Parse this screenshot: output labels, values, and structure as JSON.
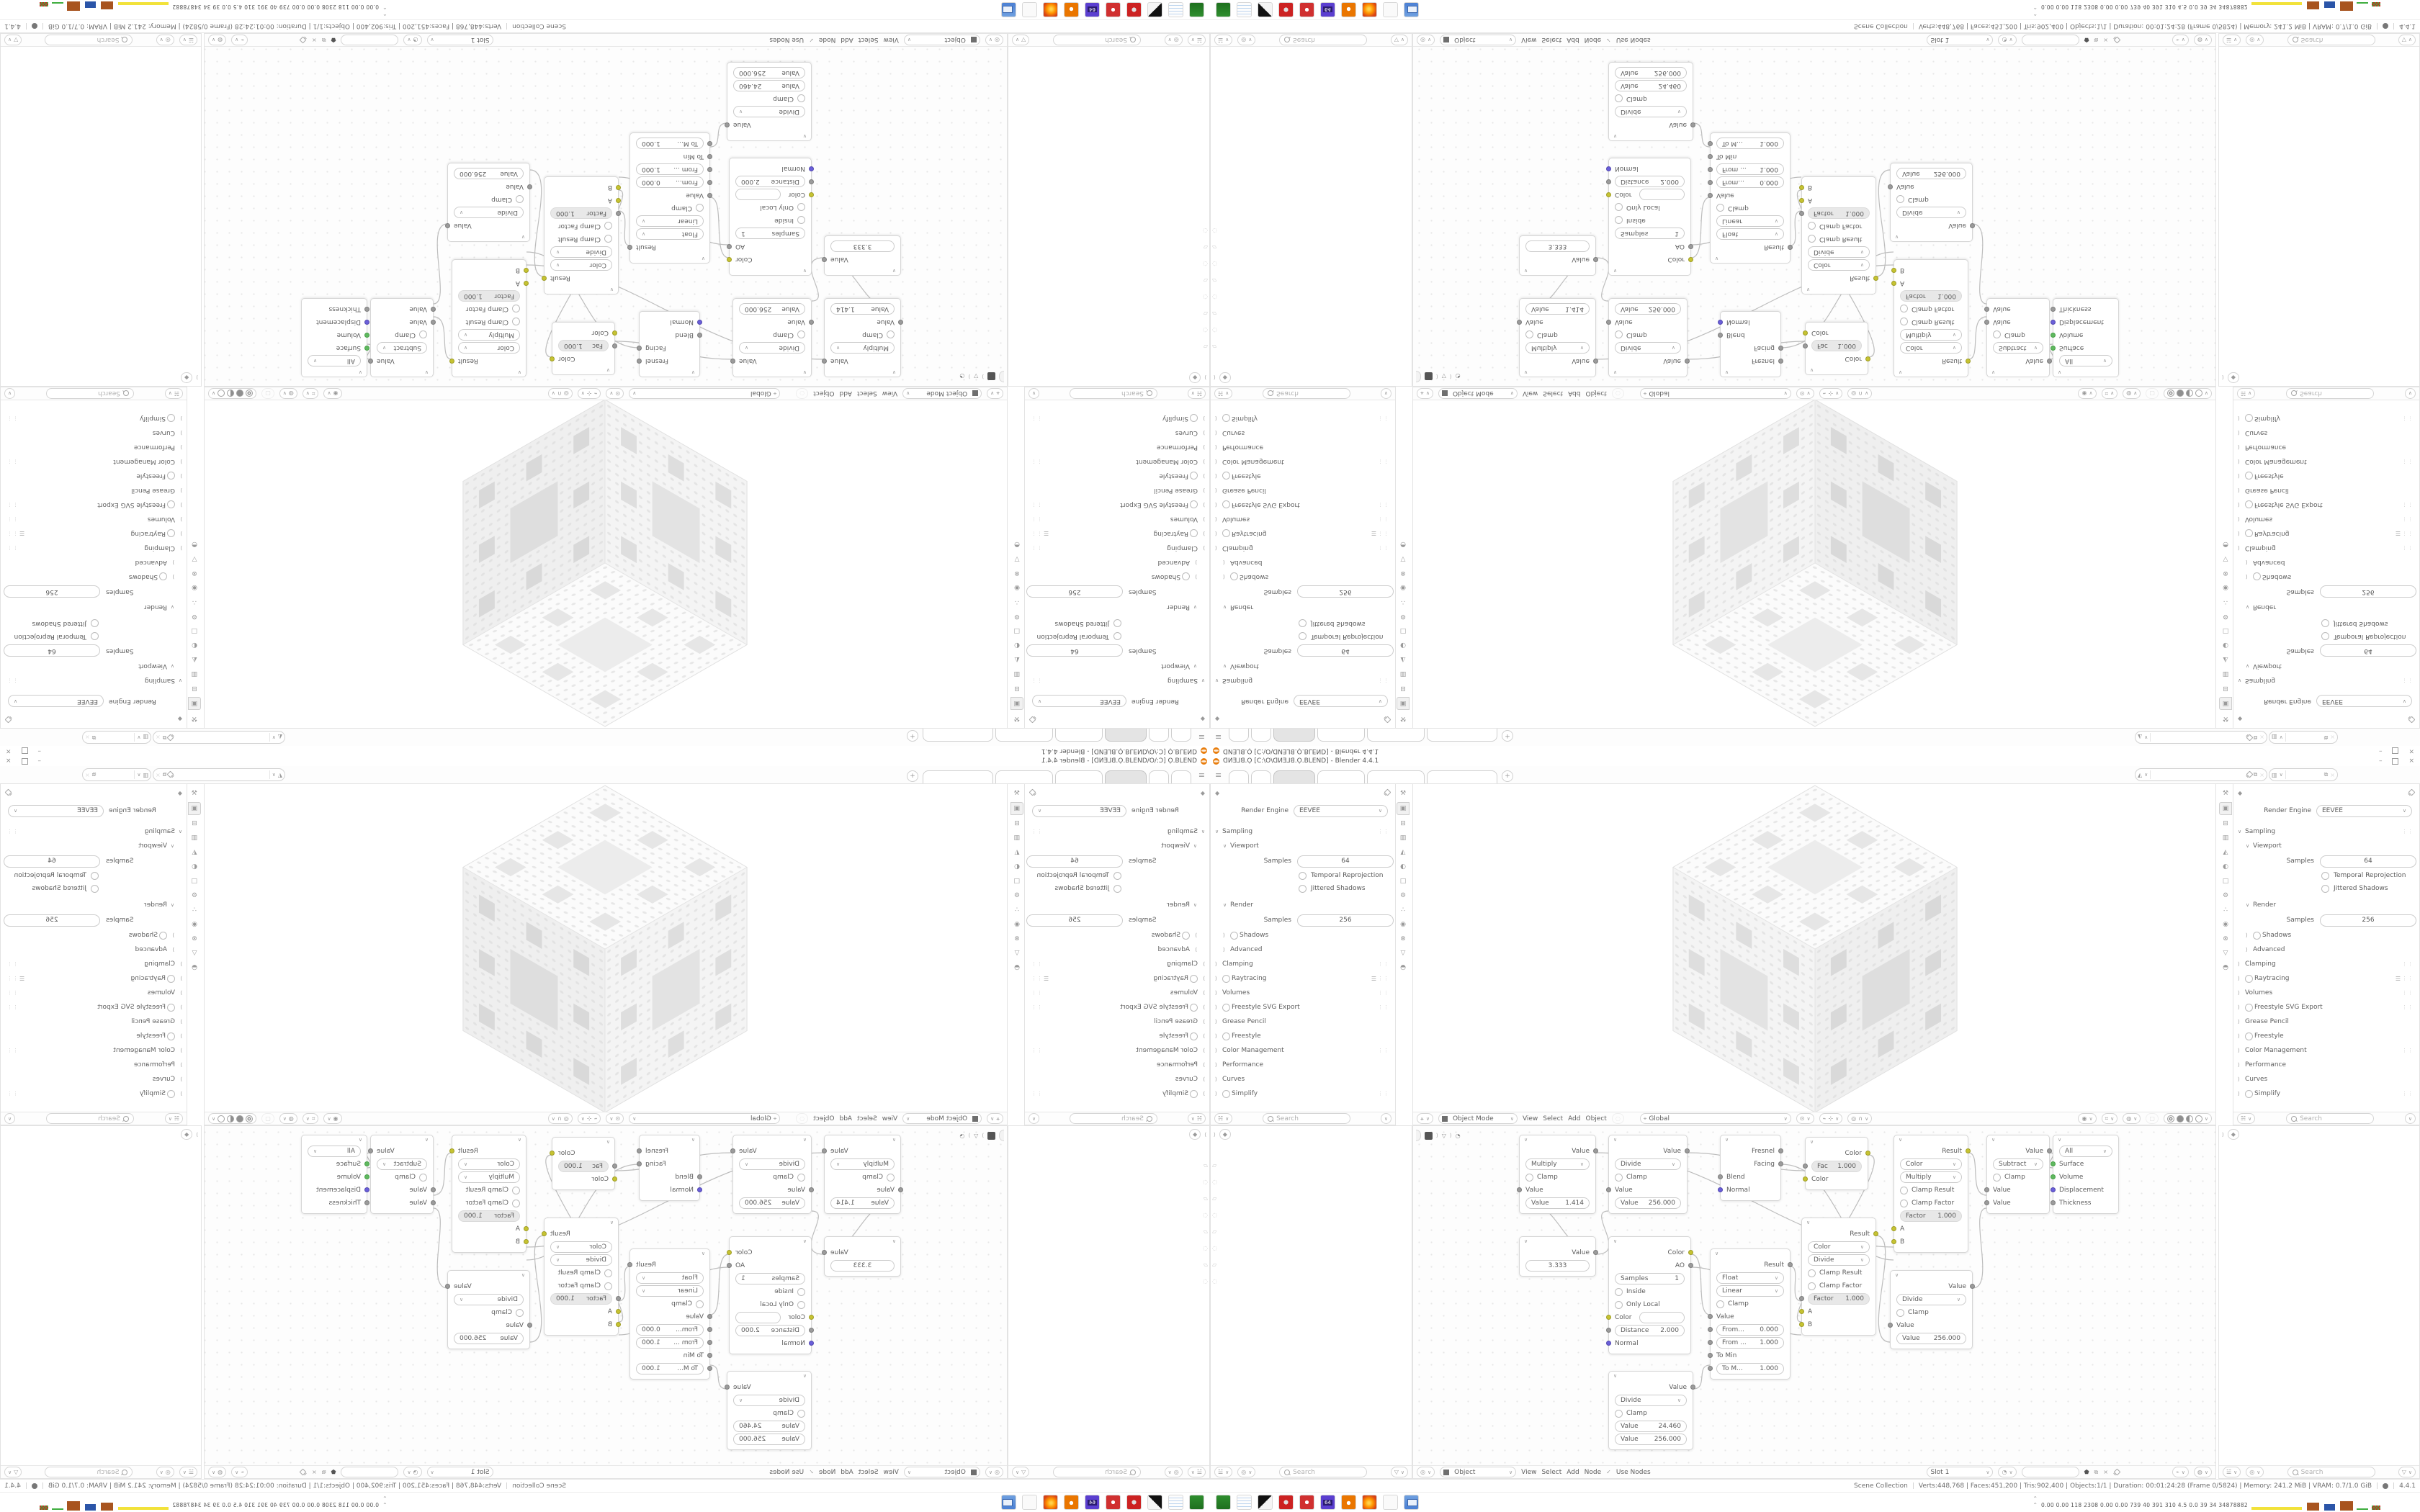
{
  "window": {
    "title": "ᗡИƎ⅃ꓭ.Ọ [C:\\O\\ᗡИƎ⅃ꓭ.Ọ.BLEND] - Blender 4.4.1",
    "minimize": "–",
    "close": "×"
  },
  "topbar": {
    "hamburger": "≡",
    "add_tab": "+",
    "workspace_tabs_blank": 6
  },
  "props": {
    "render_engine_label": "Render Engine",
    "render_engine_value": "EEVEE",
    "search_placeholder": "Search",
    "rows": [
      {
        "label": "Sampling"
      },
      {
        "label": "Viewport"
      },
      {
        "label": "Samples",
        "value": "64"
      },
      {
        "label": "Temporal Reprojection"
      },
      {
        "label": "Jittered Shadows"
      },
      {
        "label": "Render"
      },
      {
        "label": "Samples",
        "value": "256"
      },
      {
        "label": "Shadows"
      },
      {
        "label": "Advanced"
      },
      {
        "label": "Clamping"
      },
      {
        "label": "Raytracing"
      },
      {
        "label": "Volumes"
      },
      {
        "label": "Freestyle SVG Export"
      },
      {
        "label": "Grease Pencil"
      },
      {
        "label": "Freestyle"
      },
      {
        "label": "Color Management"
      },
      {
        "label": "Performance"
      },
      {
        "label": "Curves"
      },
      {
        "label": "Simplify"
      }
    ]
  },
  "viewport": {
    "mode": "Object Mode",
    "menus": [
      "View",
      "Select",
      "Add",
      "Object"
    ],
    "orientation": "Global"
  },
  "shader_editor": {
    "context": "Object",
    "menus": [
      "View",
      "Select",
      "Add",
      "Node"
    ],
    "use_nodes": "Use Nodes",
    "slot": "Slot 1"
  },
  "nodes": {
    "math1": {
      "out": "Value",
      "op": "Multiply",
      "clamp": "Clamp",
      "in0": "Value",
      "field_label": "Value",
      "field_value": "1.414"
    },
    "math2": {
      "out": "Value",
      "op": "Divide",
      "clamp": "Clamp",
      "in0": "Value",
      "field_label": "Value",
      "field_value": "256.000"
    },
    "layer_weight": {
      "out0": "Fresnel",
      "out1": "Facing",
      "in0": "Blend",
      "in1": "Normal"
    },
    "invert": {
      "out": "Color",
      "field_label": "Fac",
      "field_value": "1.000",
      "in0": "Color"
    },
    "mix_multiply": {
      "out": "Result",
      "dd0": "Color",
      "dd1": "Multiply",
      "chk0": "Clamp Result",
      "chk1": "Clamp Factor",
      "field_label": "Factor",
      "field_value": "1.000",
      "in0": "A",
      "in1": "B"
    },
    "math3": {
      "out": "Value",
      "op": "Subtract",
      "clamp": "Clamp",
      "in0": "Value",
      "in1": "Value"
    },
    "material_output": {
      "dd": "All",
      "in0": "Surface",
      "in1": "Volume",
      "in2": "Displacement",
      "in3": "Thickness"
    },
    "value": {
      "out": "Value",
      "field_value": "3.333"
    },
    "ao": {
      "out0": "Color",
      "out1": "AO",
      "f0_label": "Samples",
      "f0_value": "1",
      "chk0": "Inside",
      "chk1": "Only Local",
      "in0": "Color",
      "f1_label": "Distance",
      "f1_value": "2.000",
      "in1": "Normal"
    },
    "map_range": {
      "out": "Result",
      "dd0": "Float",
      "dd1": "Linear",
      "chk": "Clamp",
      "in0": "Value",
      "f0_label": "From...",
      "f0_value": "0.000",
      "f1_label": "From ...",
      "f1_value": "1.000",
      "in1": "To Min",
      "f2_label": "To M...",
      "f2_value": "1.000"
    },
    "mix_divide": {
      "out": "Result",
      "dd0": "Color",
      "dd1": "Divide",
      "chk0": "Clamp Result",
      "chk1": "Clamp Factor",
      "field_label": "Factor",
      "field_value": "1.000",
      "in0": "A",
      "in1": "B"
    },
    "math4": {
      "out": "Value",
      "op": "Divide",
      "clamp": "Clamp",
      "in0": "Value",
      "field_label": "Value",
      "field_value": "256.000"
    },
    "math5": {
      "out": "Value",
      "op": "Divide",
      "clamp": "Clamp",
      "f0_label": "Value",
      "f0_value": "24.460",
      "f1_label": "Value",
      "f1_value": "256.000"
    }
  },
  "status": {
    "collection": "Scene Collection",
    "stats": "Verts:448,768 | Faces:451,200 | Tris:902,400 | Objects:1/1 | Duration: 00:01:24:28 (Frame 0/5824) | Memory: 241.2 MiB | VRAM: 0.7/1.0 GiB",
    "version": "4.4.1"
  },
  "taskbar": {
    "monitor_values": "0.00 0.00  118  2308 0.00 0.00  739   40   391  310  4.5   0.0   39    34  34878882",
    "icon_names": [
      "gpu-utility-icon",
      "notepad-icon",
      "irfanview-icon",
      "red-gear-icon",
      "red-settings-icon",
      "floppy64-icon",
      "blender-icon",
      "firefox-icon",
      "blank-app-icon",
      "system-monitor-icon"
    ]
  },
  "colors": {
    "accent_blender_orange": "#ea7600",
    "socket_yellow": "#c6c332",
    "socket_green": "#5fb85f",
    "socket_purple": "#6a5fd9",
    "socket_gray": "#9b9b9b",
    "area_border": "#e3e3e3",
    "active_tab_fill": "#e4e4e4"
  },
  "mosaic_note": "single 1680x1050 Blender desktop screenshot mirrored into 4 quadrants (horizontal + vertical reflection)"
}
